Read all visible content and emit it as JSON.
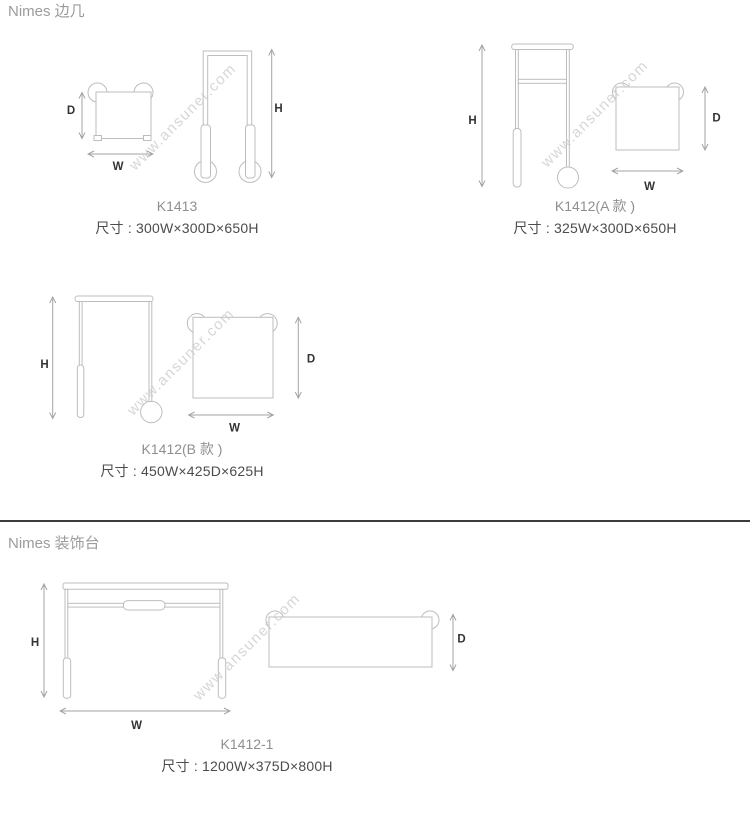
{
  "sections": [
    {
      "heading": "Nimes 边几",
      "products": [
        {
          "model": "K1413",
          "size": "尺寸 : 300W×300D×650H"
        },
        {
          "model": "K1412(A 款 )",
          "size": "尺寸 : 325W×300D×650H"
        },
        {
          "model": "K1412(B 款 )",
          "size": "尺寸 : 450W×425D×625H"
        }
      ]
    },
    {
      "heading": "Nimes 装饰台",
      "products": [
        {
          "model": "K1412-1",
          "size": "尺寸 : 1200W×375D×800H"
        }
      ]
    }
  ],
  "dimension_labels": {
    "width": "W",
    "depth": "D",
    "height": "H"
  },
  "watermark": {
    "text": "www.ansuner.com"
  },
  "colors": {
    "drawing_line": "#bdbdbd",
    "dimension_line": "#a3a3a3",
    "dimension_label_text": "#333333",
    "model_text": "#8f8f8f",
    "size_text": "#4c4c4c",
    "heading_text": "#9b9b9b",
    "divider": "#3c3c3c",
    "watermark_text": "#cccccc",
    "background": "#ffffff"
  }
}
